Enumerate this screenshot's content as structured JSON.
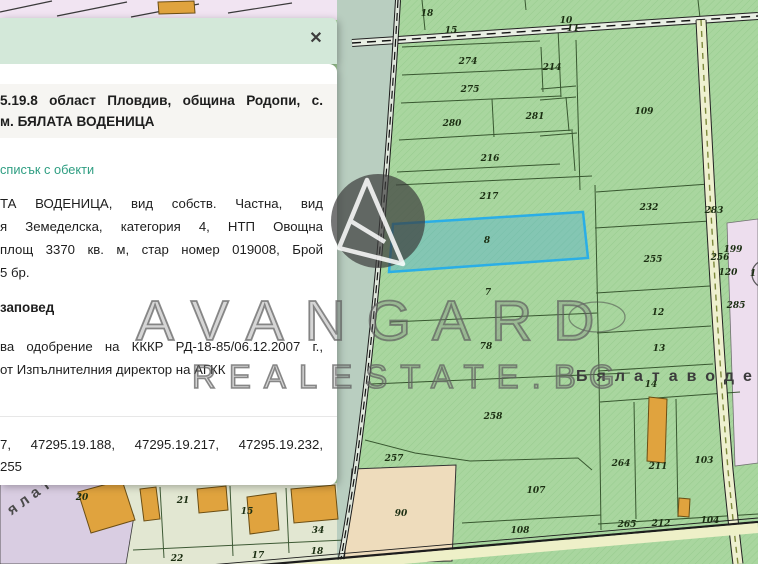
{
  "popup": {
    "close_label": "✕",
    "title_line1": "5.19.8 област Пловдив, община Родопи, с.",
    "title_line2": "м. БЯЛАТА ВОДЕНИЦА",
    "link": "списък с обекти",
    "body_lines": [
      "ТА ВОДЕНИЦА, вид собств. Частна, вид",
      "я Земеделска, категория 4, НТП Овощна",
      "площ 3370 кв. м, стар номер 019008, Брой",
      "5 бр."
    ],
    "section_heading": "заповед",
    "order_lines": [
      "ва одобрение на КККР РД-18-85/06.12.2007 г.,",
      "от Изпълнителния директор на АГКК"
    ],
    "numbers_line1": "7, 47295.19.188, 47295.19.217, 47295.19.232,",
    "numbers_line2": "255"
  },
  "watermark": {
    "brand": "AVANGARD",
    "domain": "REALESTATE.BG",
    "logo": "avangard-logo"
  },
  "map": {
    "selected_parcel": "8",
    "area_label_right": "Бялатаводе",
    "area_label_left": "ялатавод",
    "colors": {
      "parcel_green": "#a9d69f",
      "selected_stroke": "#2aaee6",
      "building_orange": "#e0a33e",
      "pink_zone": "#eddeee",
      "lavender_zone": "#d9cde2",
      "tan_parcel": "#eedcbc",
      "popup_header": "#d3e8d9",
      "link_green": "#2f9e82"
    },
    "parcels": [
      {
        "t": "18",
        "x": 427,
        "y": 14
      },
      {
        "t": "15",
        "x": 451,
        "y": 31
      },
      {
        "t": "10",
        "x": 566,
        "y": 21
      },
      {
        "t": "11",
        "x": 573,
        "y": 29
      },
      {
        "t": "274",
        "x": 468,
        "y": 62
      },
      {
        "t": "214",
        "x": 552,
        "y": 68
      },
      {
        "t": "275",
        "x": 470,
        "y": 90
      },
      {
        "t": "280",
        "x": 452,
        "y": 124
      },
      {
        "t": "281",
        "x": 535,
        "y": 117
      },
      {
        "t": "216",
        "x": 490,
        "y": 159
      },
      {
        "t": "109",
        "x": 644,
        "y": 112
      },
      {
        "t": "217",
        "x": 489,
        "y": 197
      },
      {
        "t": "232",
        "x": 649,
        "y": 208
      },
      {
        "t": "283",
        "x": 714,
        "y": 211
      },
      {
        "t": "8",
        "x": 487,
        "y": 241
      },
      {
        "t": "255",
        "x": 653,
        "y": 260
      },
      {
        "t": "256",
        "x": 720,
        "y": 258
      },
      {
        "t": "199",
        "x": 733,
        "y": 250
      },
      {
        "t": "120",
        "x": 728,
        "y": 273
      },
      {
        "t": "285",
        "x": 736,
        "y": 306
      },
      {
        "t": "7",
        "x": 488,
        "y": 293
      },
      {
        "t": "12",
        "x": 658,
        "y": 313
      },
      {
        "t": "78",
        "x": 486,
        "y": 347
      },
      {
        "t": "13",
        "x": 659,
        "y": 349
      },
      {
        "t": "14",
        "x": 651,
        "y": 385
      },
      {
        "t": "258",
        "x": 493,
        "y": 417
      },
      {
        "t": "257",
        "x": 394,
        "y": 459
      },
      {
        "t": "90",
        "x": 401,
        "y": 514
      },
      {
        "t": "107",
        "x": 536,
        "y": 491
      },
      {
        "t": "108",
        "x": 520,
        "y": 531
      },
      {
        "t": "264",
        "x": 621,
        "y": 464
      },
      {
        "t": "211",
        "x": 658,
        "y": 467
      },
      {
        "t": "103",
        "x": 704,
        "y": 461
      },
      {
        "t": "265",
        "x": 627,
        "y": 525
      },
      {
        "t": "212",
        "x": 661,
        "y": 524
      },
      {
        "t": "104",
        "x": 710,
        "y": 521
      },
      {
        "t": "20",
        "x": 82,
        "y": 498
      },
      {
        "t": "21",
        "x": 183,
        "y": 501
      },
      {
        "t": "15",
        "x": 247,
        "y": 512
      },
      {
        "t": "34",
        "x": 318,
        "y": 531
      },
      {
        "t": "22",
        "x": 177,
        "y": 559
      },
      {
        "t": "17",
        "x": 258,
        "y": 556
      },
      {
        "t": "18",
        "x": 317,
        "y": 552
      },
      {
        "t": "1",
        "x": 753,
        "y": 274
      }
    ]
  }
}
